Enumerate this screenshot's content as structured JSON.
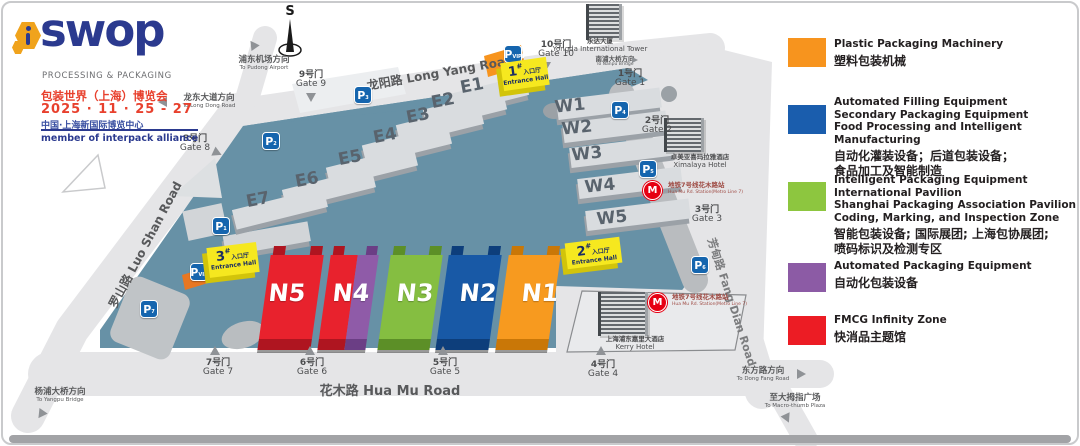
{
  "logo": {
    "brand": "swop",
    "tagline": "PROCESSING & PACKAGING",
    "title_cn": "包装世界（上海）博览会",
    "dates": "2025 · 11 · 25 - 27",
    "venue_cn": "中国·上海新国际博览中心",
    "alliance": "member of interpack alliance"
  },
  "map": {
    "compass": "S",
    "roads": {
      "longyang": "龙阳路 Long Yang Road",
      "luoshan": "罗山路 Luo Shan Road",
      "huamu": "花木路 Hua Mu Road",
      "fangdian": "芳甸路 Fang Dian Road"
    },
    "directions": {
      "pudong": {
        "cn": "浦东机场方向",
        "en": "To Pudong Airport"
      },
      "longdong": {
        "cn": "龙东大道方向",
        "en": "To Long Dong Road"
      },
      "nanpu": {
        "cn": "南浦大桥方向",
        "en": "To Nanpu Bridge"
      },
      "yangpu": {
        "cn": "杨浦大桥方向",
        "en": "To Yangpu Bridge"
      },
      "dongfang": {
        "cn": "东方路方向",
        "en": "To Dong Fang Road"
      },
      "thumb": {
        "cn": "至大拇指广场",
        "en": "To Macro-thumb Plaza"
      }
    },
    "gates": [
      {
        "cn": "1号门",
        "en": "Gate 1"
      },
      {
        "cn": "2号门",
        "en": "Gate 2"
      },
      {
        "cn": "3号门",
        "en": "Gate 3"
      },
      {
        "cn": "4号门",
        "en": "Gate 4"
      },
      {
        "cn": "5号门",
        "en": "Gate 5"
      },
      {
        "cn": "6号门",
        "en": "Gate 6"
      },
      {
        "cn": "7号门",
        "en": "Gate 7"
      },
      {
        "cn": "8号门",
        "en": "Gate 8"
      },
      {
        "cn": "9号门",
        "en": "Gate 9"
      },
      {
        "cn": "10号门",
        "en": "Gate 10"
      }
    ],
    "halls": {
      "east": [
        "E1",
        "E2",
        "E3",
        "E4",
        "E5",
        "E6",
        "E7"
      ],
      "west": [
        "W1",
        "W2",
        "W3",
        "W4",
        "W5"
      ],
      "north": [
        {
          "name": "N5",
          "color": "#E8222D",
          "shade": "#AF1520"
        },
        {
          "name": "N4",
          "color": "#E8222D",
          "shade": "#AF1520",
          "color2": "#8F5BA8",
          "shade2": "#6B3E85"
        },
        {
          "name": "N3",
          "color": "#85BE41",
          "shade": "#5C8F27"
        },
        {
          "name": "N2",
          "color": "#1859A6",
          "shade": "#0D3E7B"
        },
        {
          "name": "N1",
          "color": "#F79A1F",
          "shade": "#C97707"
        }
      ]
    },
    "entrances": [
      {
        "num": "1",
        "hash": "#",
        "cn": "入口厅",
        "en": "Entrance Hall"
      },
      {
        "num": "2",
        "hash": "#",
        "cn": "入口厅",
        "en": "Entrance Hall"
      },
      {
        "num": "3",
        "hash": "#",
        "cn": "入口厅",
        "en": "Entrance Hall"
      }
    ],
    "parking": {
      "letter": "P",
      "subs": {
        "p1": "1",
        "p2": "2",
        "p3": "3",
        "p4": "4",
        "p5": "5",
        "p6": "6",
        "p7": "7",
        "vip": "VIP"
      }
    },
    "metro": {
      "icon": "M",
      "cn": "地铁7号线花木路站",
      "en": "Hua Mu Rd. Station(Metro Line 7)"
    },
    "landmarks": {
      "yongda": {
        "cn": "永达大厦",
        "en": "Yongda International Tower"
      },
      "ximalaya": {
        "cn": "卓美亚喜玛拉雅酒店",
        "en": "Ximalaya Hotel"
      },
      "kerry": {
        "cn": "上海浦东嘉里大酒店",
        "en": "Kerry Hotel"
      }
    }
  },
  "legend": {
    "items": [
      {
        "color": "#F7941E",
        "en": "Plastic Packaging Machinery",
        "cn": "塑料包装机械"
      },
      {
        "color": "#1A5DAD",
        "en": "Automated Filling Equipment\nSecondary Packaging Equipment\nFood Processing and Intelligent Manufacturing",
        "cn": "自动化灌装设备；后道包装设备；\n食品加工及智能制造"
      },
      {
        "color": "#8DC63F",
        "en": "Intelligent Packaging Equipment\nInternational Pavilion\nShanghai Packaging Association Pavilion\nCoding, Marking, and Inspection Zone",
        "cn": "智能包装设备; 国际展团; 上海包协展团;\n喷码标识及检测专区"
      },
      {
        "color": "#8C5BA5",
        "en": "Automated Packaging Equipment",
        "cn": "自动化包装设备"
      },
      {
        "color": "#EC1C24",
        "en": "FMCG Infinity Zone",
        "cn": "快消品主题馆"
      }
    ]
  }
}
